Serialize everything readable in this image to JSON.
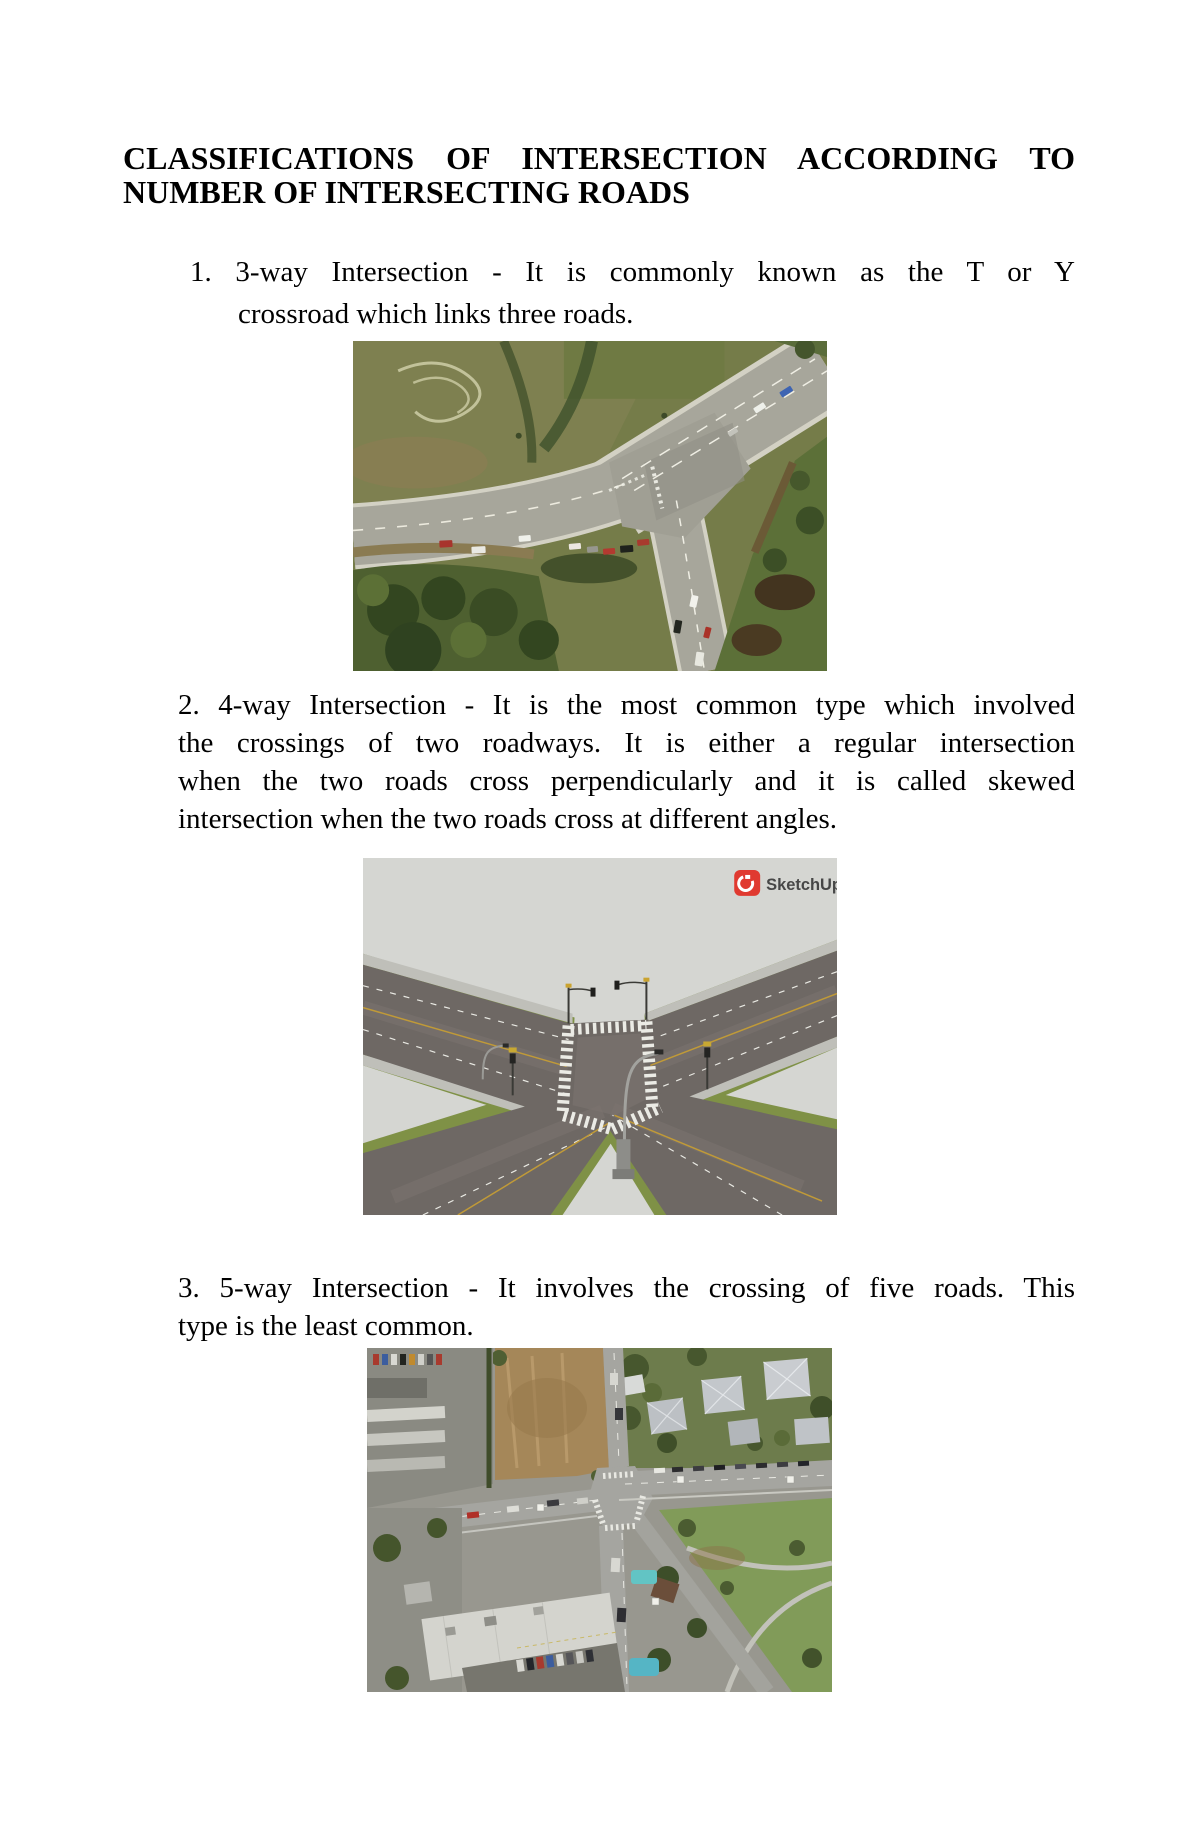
{
  "document": {
    "heading": {
      "line1": "CLASSIFICATIONS OF INTERSECTION ACCORDING TO",
      "line2": "NUMBER OF INTERSECTING ROADS"
    },
    "items": [
      {
        "lines": [
          "1. 3-way Intersection - It is commonly known as the T or Y",
          "crossroad which links three roads."
        ]
      },
      {
        "lines": [
          "2. 4-way Intersection - It is the most common type which involved",
          "the crossings of two roadways. It is either a regular intersection",
          "when the two roads cross perpendicularly and it is called skewed",
          "intersection when the two roads cross at different angles."
        ],
        "watermark": "SketchUp"
      },
      {
        "lines": [
          "3. 5-way Intersection - It involves the crossing of five roads. This",
          "type is the least common."
        ]
      }
    ]
  }
}
